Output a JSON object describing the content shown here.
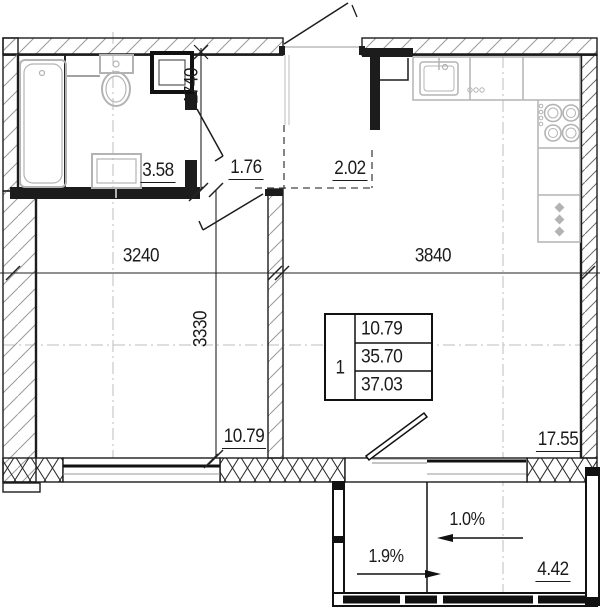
{
  "areas": {
    "bathroom": "3.58",
    "hallway": "1.76",
    "entry": "2.02",
    "living_room": "10.79",
    "kitchen_living": "17.55",
    "balcony": "4.42"
  },
  "dims": {
    "hallway_depth": "1740",
    "left_width": "3240",
    "right_width": "3840",
    "rooms_depth": "3330"
  },
  "info_box": {
    "unit_number": "1",
    "living_area": "10.79",
    "area_excl_balcony": "35.70",
    "total_area": "37.03"
  },
  "slopes": {
    "left": "1.9%",
    "right": "1.0%"
  },
  "colors": {
    "line": "#1c1c1c",
    "fixture": "#b3b3b3",
    "background": "#ffffff"
  }
}
